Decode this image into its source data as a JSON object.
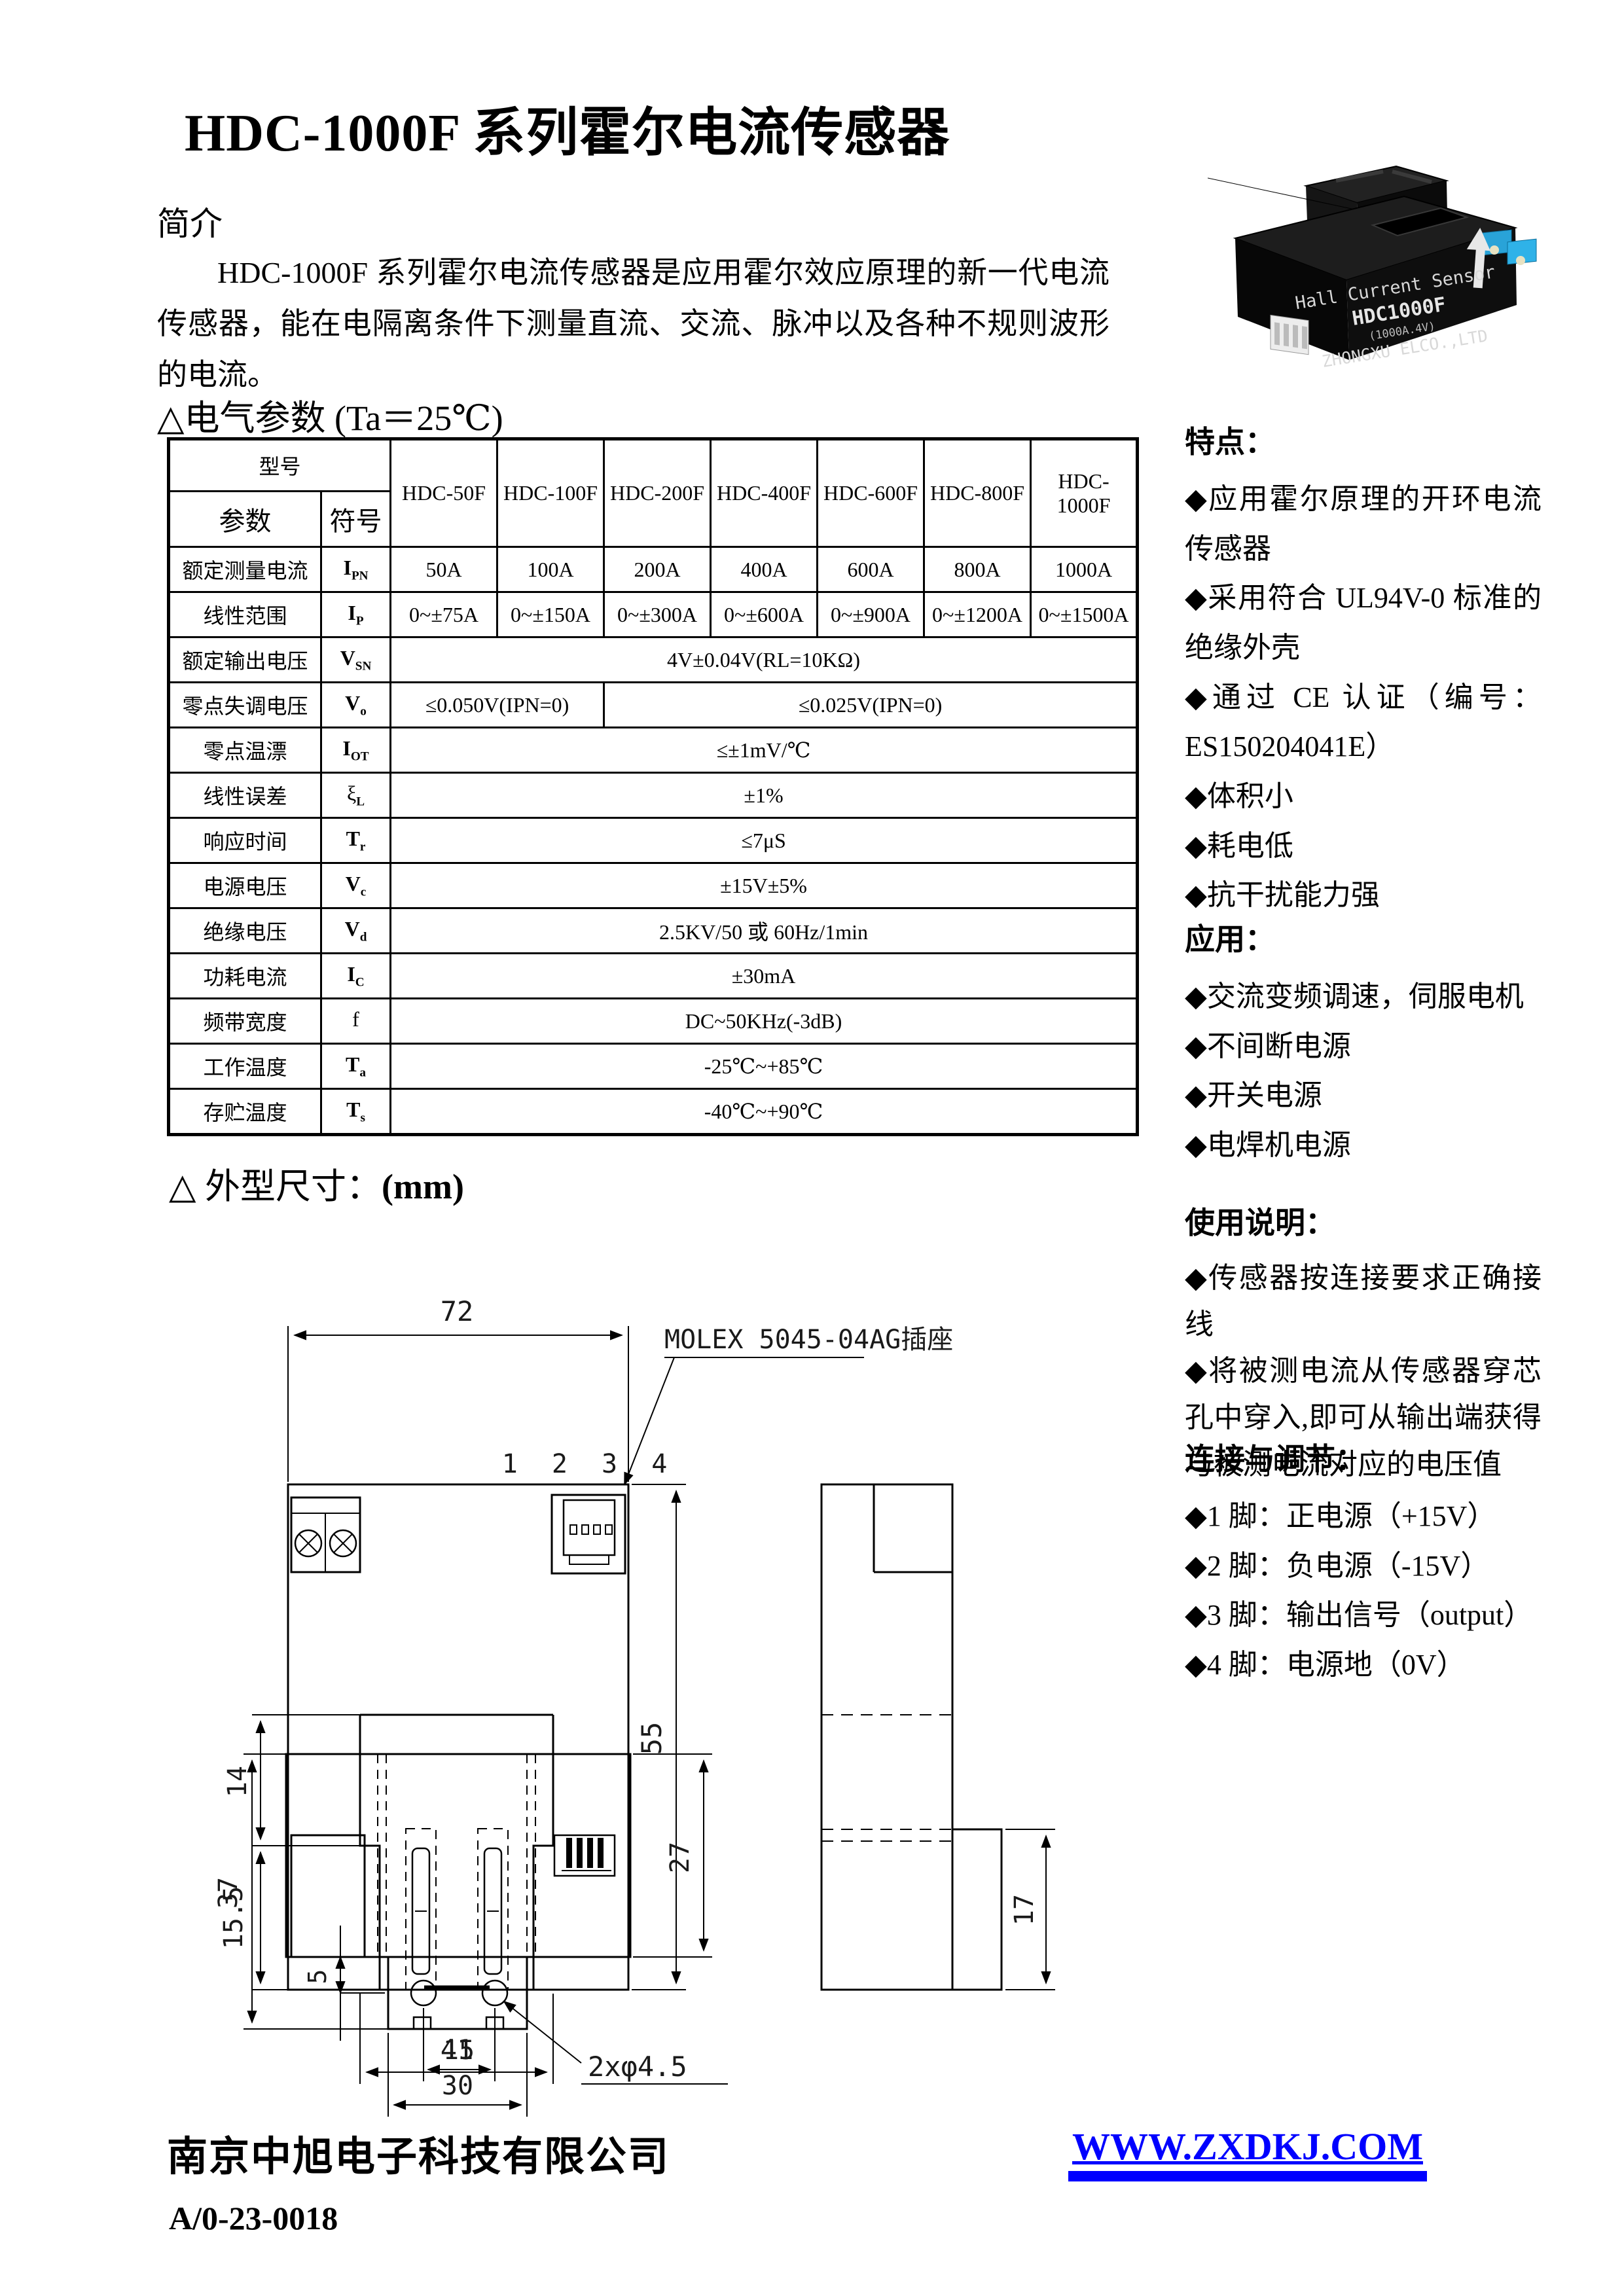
{
  "colors": {
    "link_blue": "#0000ff",
    "line_black": "#000000"
  },
  "page": {
    "title": "HDC-1000F 系列霍尔电流传感器"
  },
  "intro": {
    "heading": "简介",
    "body": "HDC-1000F 系列霍尔电流传感器是应用霍尔效应原理的新一代电流传感器，能在电隔离条件下测量直流、交流、脉冲以及各种不规则波形的电流。"
  },
  "photo": {
    "line1": "Hall Current Sensor",
    "line2": "HDC1000F",
    "line3": "(1000A.4V)",
    "line4": "ZHONGXU ELCO.,LTD"
  },
  "params": {
    "heading": "△电气参数 (Ta＝25℃)",
    "table": {
      "corner_top": "型号",
      "corner_param": "参数",
      "corner_symbol": "符号",
      "models": [
        "HDC-50F",
        "HDC-100F",
        "HDC-200F",
        "HDC-400F",
        "HDC-600F",
        "HDC-800F",
        "HDC-1000F"
      ],
      "rows": [
        {
          "name": "额定测量电流",
          "sym": "I",
          "sub": "PN",
          "values": [
            "50A",
            "100A",
            "200A",
            "400A",
            "600A",
            "800A",
            "1000A"
          ]
        },
        {
          "name": "线性范围",
          "sym": "I",
          "sub": "P",
          "values": [
            "0~±75A",
            "0~±150A",
            "0~±300A",
            "0~±600A",
            "0~±900A",
            "0~±1200A",
            "0~±1500A"
          ]
        },
        {
          "name": "额定输出电压",
          "sym": "V",
          "sub": "SN",
          "span": "4V±0.04V(RL=10KΩ)"
        },
        {
          "name": "零点失调电压",
          "sym": "V",
          "sub": "o",
          "span_a": "≤0.050V(IPN=0)",
          "span_b": "≤0.025V(IPN=0)"
        },
        {
          "name": "零点温漂",
          "sym": "I",
          "sub": "OT",
          "span": "≤±1mV/℃"
        },
        {
          "name": "线性误差",
          "sym": "ξ",
          "sub": "L",
          "span": "±1%"
        },
        {
          "name": "响应时间",
          "sym": "T",
          "sub": "r",
          "span": "≤7μS"
        },
        {
          "name": "电源电压",
          "sym": "V",
          "sub": "c",
          "span": "±15V±5%"
        },
        {
          "name": "绝缘电压",
          "sym": "V",
          "sub": "d",
          "span": "2.5KV/50 或 60Hz/1min"
        },
        {
          "name": "功耗电流",
          "sym": "I",
          "sub": "C",
          "span": "±30mA"
        },
        {
          "name": "频带宽度",
          "sym": "f",
          "sub": "",
          "span": "DC~50KHz(-3dB)"
        },
        {
          "name": "工作温度",
          "sym": "T",
          "sub": "a",
          "span": "-25℃~+85℃"
        },
        {
          "name": "存贮温度",
          "sym": "T",
          "sub": "s",
          "span": "-40℃~+90℃"
        }
      ]
    }
  },
  "sidebar": {
    "features": {
      "heading": "特点：",
      "items": [
        "◆应用霍尔原理的开环电流传感器",
        "◆采用符合 UL94V-0 标准的绝缘外壳",
        "◆通过 CE 认证（编号：ES150204041E）",
        "◆体积小",
        "◆耗电低",
        "◆抗干扰能力强"
      ]
    },
    "applications": {
      "heading": "应用：",
      "items": [
        "◆交流变频调速，伺服电机",
        "◆不间断电源",
        "◆开关电源",
        "◆电焊机电源"
      ]
    },
    "usage": {
      "heading": "使用说明：",
      "items": [
        "◆传感器按连接要求正确接线",
        "◆将被测电流从传感器穿芯孔中穿入,即可从输出端获得与被测电流对应的电压值"
      ]
    },
    "connection": {
      "heading": "连接与调节：",
      "items": [
        "◆1 脚：正电源（+15V）",
        "◆2 脚：负电源（-15V）",
        "◆3 脚：输出信号（output）",
        "◆4 脚：电源地（0V）"
      ]
    }
  },
  "dims": {
    "heading_prefix": "△ 外型尺寸：",
    "heading_unit": "(mm)",
    "labels": {
      "w72": "72",
      "h55": "55",
      "h14": "14",
      "h155": "15.5",
      "w41": "41",
      "h17": "17",
      "h37": "37",
      "h27": "27",
      "d5": "5",
      "w15": "15",
      "w30": "30",
      "holes": "2xφ4.5",
      "pins": "1 2 3 4",
      "molex": "MOLEX 5045-04AG插座"
    }
  },
  "footer": {
    "company": "南京中旭电子科技有限公司",
    "doc_no": "A/0-23-0018",
    "website": "WWW.ZXDKJ.COM"
  }
}
